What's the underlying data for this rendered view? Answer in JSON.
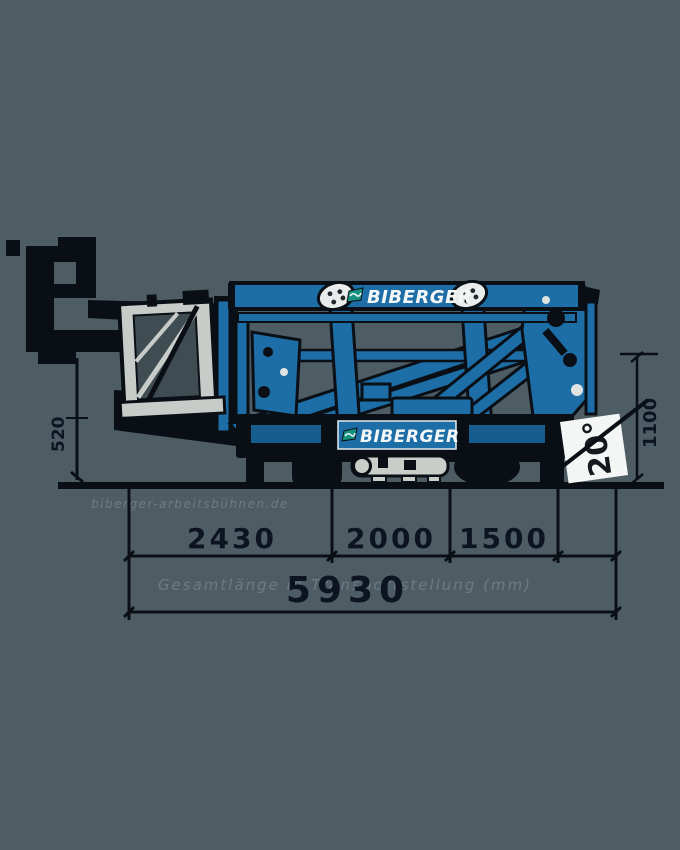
{
  "machine": {
    "brand_top": "BIBERGER",
    "brand_side": "BIBERGER"
  },
  "angle": {
    "value": "20°"
  },
  "dimensions": {
    "segments": [
      {
        "value": "2430"
      },
      {
        "value": "2000"
      },
      {
        "value": "1500"
      }
    ],
    "total": {
      "value": "5930"
    },
    "caption": "Gesamtlänge in Transportstellung (mm)",
    "watermark": "biberger-arbeitsbühnen.de",
    "jack_height": "520",
    "side_height": "1100"
  },
  "colors": {
    "background": "#4e5d64",
    "machine_blue": "#1d6da6",
    "outline": "#0a0f16",
    "basket_grey": "#c7ccc9",
    "logo_white": "#f4f7f8",
    "angle_box": "#f4f6f5",
    "dim_text": "#0c1421"
  }
}
